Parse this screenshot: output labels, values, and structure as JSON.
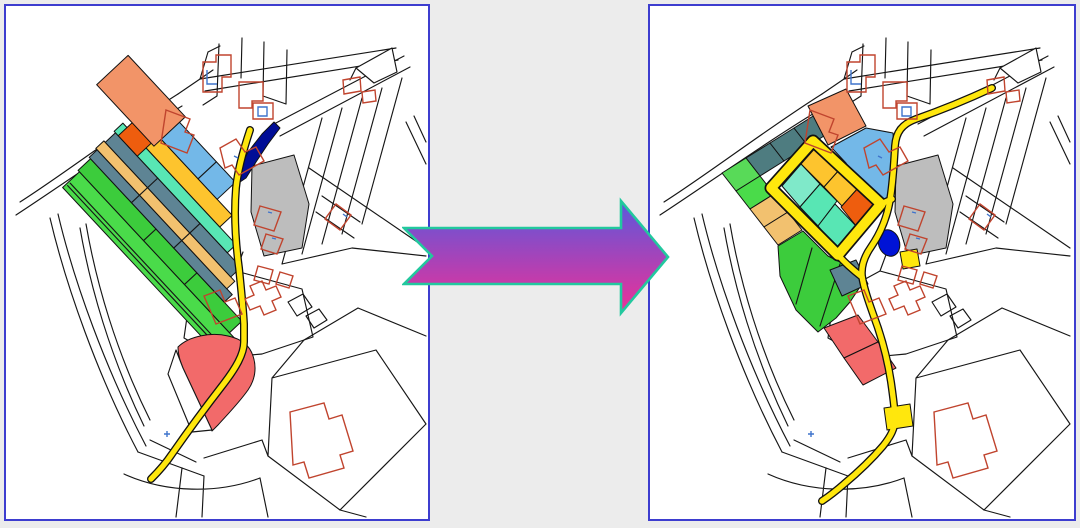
{
  "scene": {
    "kind": "before-after map figure",
    "left_panel": "parcel map before reallocation (narrow strips)",
    "right_panel": "parcel map after reallocation (block grid with new road loop)"
  },
  "colors": {
    "page_background": "#ececec",
    "panel_background": "#ffffff",
    "panel_border": "#3d3dcf",
    "map_line": "#161616",
    "building_outline": "#c0442e",
    "building_accent": "#3f74cc",
    "road_fill": "#ffe70d",
    "road_casing": "#111111",
    "water_navy": "#000d96",
    "navy_right": "#0013d6",
    "green_bright": "#4adb4a",
    "green_mid": "#3ccc3c",
    "green_light": "#58da58",
    "slate": "#5e8494",
    "slate_teal": "#4e7c80",
    "sand": "#f2c16f",
    "turquoise": "#58e6b4",
    "mint": "#7fe9c9",
    "gold": "#fdc42e",
    "orange_dark": "#ee5d0e",
    "salmon": "#f29468",
    "blue_light": "#73b8e8",
    "gray_parcel": "#bdbdbd",
    "red_area": "#f26a6a",
    "white_area": "#ffffff",
    "arrow_gradient_top": "#5b58dc",
    "arrow_gradient_bottom": "#ee3097",
    "arrow_outline": "#22c89e"
  }
}
